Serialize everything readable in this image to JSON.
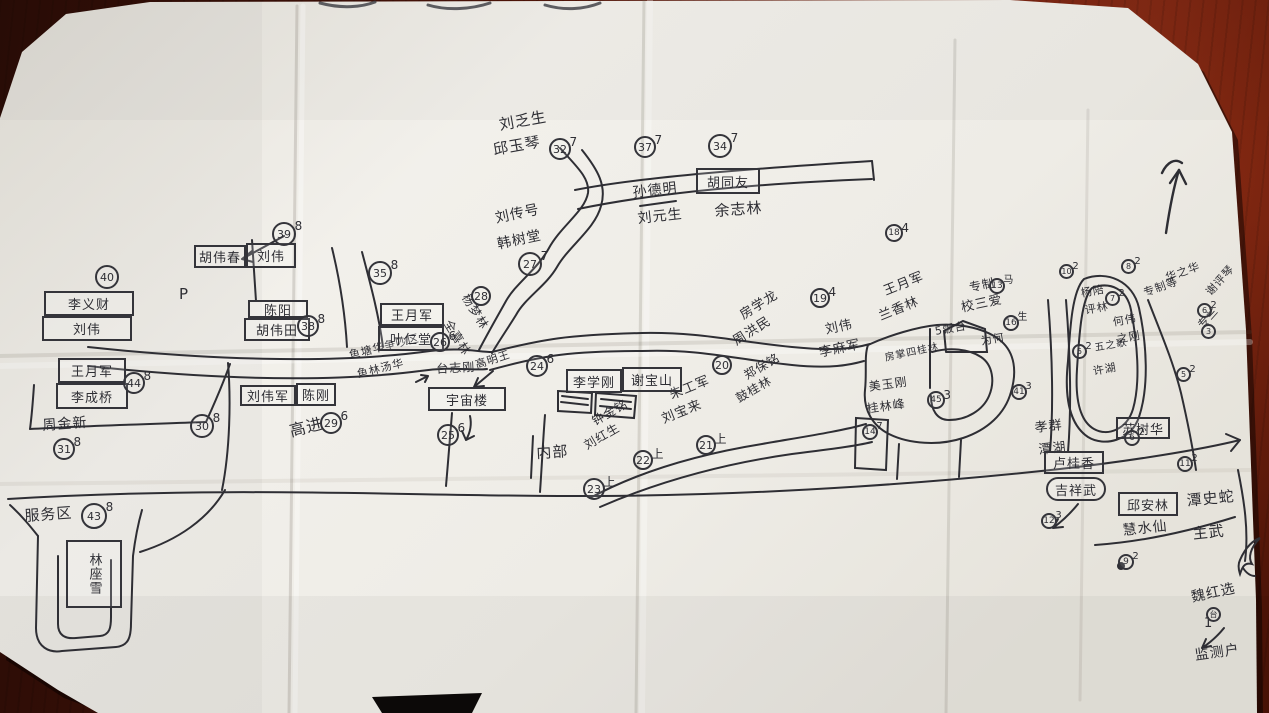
{
  "colors": {
    "paper": "#f0eee9",
    "ink": "#2e2e34",
    "wood": "#5c1a0e"
  },
  "map": {
    "labels": [
      "刘乏生",
      "邱玉琴",
      "孙德明",
      "刘元生",
      "余志林",
      "刘传号",
      "韩树堂",
      "杨梦林",
      "全喜林",
      "P",
      "台志刚",
      "高明王",
      "高进",
      "鱼塘华争吵区",
      "鱼林汤华",
      "内部",
      "钟金铭",
      "刘红生",
      "朱工军",
      "刘宝来",
      "郑保铭",
      "鼓桂林",
      "房学龙",
      "周洪民",
      "刘伟",
      "李麻军",
      "王月军",
      "兰香林",
      "专制",
      "校三爱",
      "5饭台",
      "为何",
      "房掌四桂林",
      "美玉刚",
      "桂林峰",
      "孝群",
      "潭湖",
      "潭史蛇",
      "主武",
      "魏红选",
      "1",
      "监测户",
      "服务区",
      "周金新",
      "华之华",
      "专制等",
      "杨陪",
      "评林",
      "何伟",
      "之刚",
      "五之歌",
      "许湖",
      "谢评琴",
      "专兰",
      "慧水仙"
    ],
    "boxes": [
      "胡同友",
      "胡伟春",
      "刘伟",
      "李义财",
      "刘伟",
      "陈阳",
      "胡伟田",
      "王月军",
      "叶仁堂",
      "宇宙楼",
      "李学刚",
      "谢宝山",
      "刘伟军",
      "陈刚",
      "王月军",
      "李成桥",
      "林座雪",
      "卢桂香",
      "吉祥武",
      "苏树华",
      "邱安林"
    ],
    "markers": [
      {
        "num": "32",
        "note": "7"
      },
      {
        "num": "37",
        "note": "7"
      },
      {
        "num": "34",
        "note": "7"
      },
      {
        "num": "27",
        "note": "7"
      },
      {
        "num": "28",
        "note": ""
      },
      {
        "num": "39",
        "note": "8"
      },
      {
        "num": "40",
        "note": ""
      },
      {
        "num": "35",
        "note": "8"
      },
      {
        "num": "38",
        "note": "8"
      },
      {
        "num": "26",
        "note": "6"
      },
      {
        "num": "24",
        "note": "6"
      },
      {
        "num": "29",
        "note": "6"
      },
      {
        "num": "30",
        "note": "8"
      },
      {
        "num": "44",
        "note": "8"
      },
      {
        "num": "31",
        "note": "8"
      },
      {
        "num": "43",
        "note": "8"
      },
      {
        "num": "25",
        "note": "6"
      },
      {
        "num": "23",
        "note": "上"
      },
      {
        "num": "22",
        "note": "上"
      },
      {
        "num": "21",
        "note": "上"
      },
      {
        "num": "20",
        "note": ""
      },
      {
        "num": "19",
        "note": "4"
      },
      {
        "num": "18",
        "note": "4"
      },
      {
        "num": "13",
        "note": "马"
      },
      {
        "num": "16",
        "note": "生"
      },
      {
        "num": "45",
        "note": "3"
      },
      {
        "num": "14",
        "note": "7"
      },
      {
        "num": "41",
        "note": "3"
      },
      {
        "num": "12",
        "note": "3"
      },
      {
        "num": "6",
        "note": "2"
      },
      {
        "num": "11",
        "note": "2"
      },
      {
        "num": "9",
        "note": "2"
      },
      {
        "num": "10",
        "note": "2"
      },
      {
        "num": "7",
        "note": "2"
      },
      {
        "num": "5",
        "note": "2"
      },
      {
        "num": "8",
        "note": "2"
      },
      {
        "num": "6",
        "note": "2"
      },
      {
        "num": "3",
        "note": ""
      },
      {
        "num": "5",
        "note": "2"
      },
      {
        "num": "台",
        "note": ""
      }
    ]
  }
}
